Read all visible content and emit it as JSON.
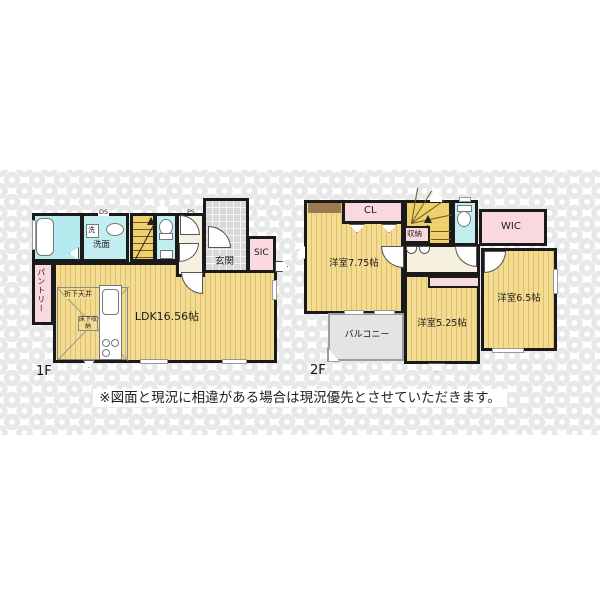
{
  "note": "※図面と現況に相違がある場合は現況優先とさせていただきます。",
  "colors": {
    "wall": "#1a1a1a",
    "tatami_yellow": "#f4db92",
    "tatami_line": "#ddbf6c",
    "stairs_yellow": "#eed06d",
    "closet_pink": "#f9d9dd",
    "wet_area_cyan": "#c2eef2",
    "hall_cream": "#f6f0df",
    "tile_gray": "#d9d9d9",
    "balcony_gray": "#e4e4e4",
    "counter_brown": "#9b7952",
    "watermark_gray": "#e8e8e8"
  },
  "icons": {
    "door-swing": "quarter-circle",
    "entry-arrow": "white pentagon",
    "window": "double gray line",
    "closet-door": "white triangle"
  },
  "floor1": {
    "label": "1F",
    "ldk": "LDK16.56帖",
    "entrance": "玄関",
    "sic": "SIC",
    "pantry": "パントリー",
    "washroom": "洗面",
    "washer": "洗",
    "ds": "DS",
    "ps": "PS",
    "dropped_ceiling": "折下天井",
    "floor_storage": "床下収納"
  },
  "floor2": {
    "label": "2F",
    "room_west": "洋室7.75帖",
    "closet": "CL",
    "storage": "収納",
    "wic": "WIC",
    "room_middle": "洋室5.25帖",
    "room_east": "洋室6.5帖",
    "balcony": "バルコニー"
  }
}
